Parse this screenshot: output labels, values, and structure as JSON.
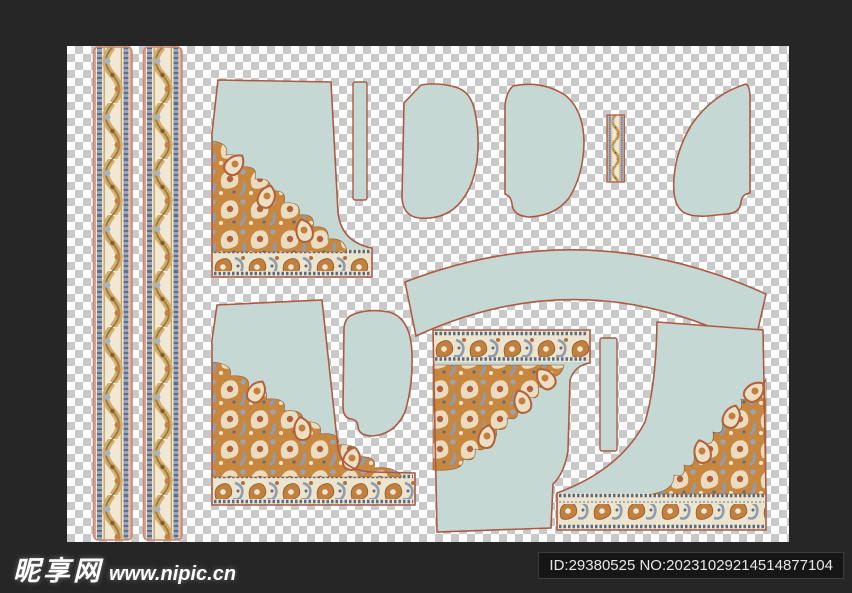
{
  "footer": {
    "logo_cn": "昵享网",
    "logo_url": "www.nipic.cn",
    "id_text": "ID:29380525 NO:20231029214514877104"
  },
  "canvas": {
    "kind": "transparency-checkerboard artboard with garment sewing-pattern pieces of a paisley border textile design",
    "checker_colors": [
      "#ffffff",
      "#c9c9c9"
    ],
    "pieces": [
      {
        "name": "border-strip-left-1",
        "kind": "tall decorated vertical border strip"
      },
      {
        "name": "border-strip-left-2",
        "kind": "tall decorated vertical border strip"
      },
      {
        "name": "front-panel-top-left",
        "kind": "panel with paisley corner and hem border"
      },
      {
        "name": "facing-strip-top",
        "kind": "narrow plain strip"
      },
      {
        "name": "sleeve-top-1",
        "kind": "plain curved piece"
      },
      {
        "name": "sleeve-top-2",
        "kind": "plain curved piece"
      },
      {
        "name": "mini-border-strip-top",
        "kind": "small decorated strip"
      },
      {
        "name": "side-panel-top-right",
        "kind": "plain curved piece"
      },
      {
        "name": "curved-waistband",
        "kind": "plain curved band"
      },
      {
        "name": "front-panel-bottom-left",
        "kind": "panel with paisley corner and hem border"
      },
      {
        "name": "sleeve-bottom",
        "kind": "plain curved piece"
      },
      {
        "name": "front-panel-bottom-middle",
        "kind": "inverted panel with paisley corner and top border"
      },
      {
        "name": "facing-strip-bottom",
        "kind": "narrow plain strip"
      },
      {
        "name": "front-panel-bottom-right",
        "kind": "panel with paisley corner and hem border"
      }
    ],
    "palette": {
      "piece_fill": "#c6d8d3",
      "outline": "#ad5a45",
      "strip_outline": "#cb8671",
      "ornament_rust": "#c2803f",
      "ornament_cream": "#ede4cd",
      "ornament_slate": "#8d9cb0",
      "ornament_navy": "#5c6b85",
      "ornament_gold": "#c9a05a"
    }
  }
}
